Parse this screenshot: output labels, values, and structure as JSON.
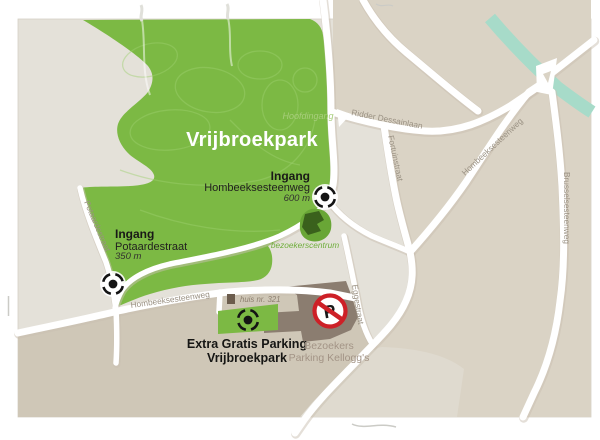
{
  "map": {
    "title": "Vrijbroekpark",
    "labels": {
      "hoofdingang": "Hoofdingang",
      "bezoekerscentrum": "bezoekerscentrum",
      "huis": "huis nr. 321",
      "parking_line1": "Extra Gratis Parking",
      "parking_line2": "Vrijbroekpark",
      "kelloggs_line1": "Bezoekers",
      "kelloggs_line2": "Parking Kellogg's",
      "no_parking_letter": "P"
    },
    "entrances": {
      "east": {
        "title": "Ingang",
        "street": "Hombeeksesteenweg",
        "distance": "600 m"
      },
      "west": {
        "title": "Ingang",
        "street": "Potaardestraat",
        "distance": "350 m"
      }
    },
    "streets": {
      "ridder": "Ridder Dessainlaan",
      "fortuin": "Fortuinstraat",
      "hombeek_diag": "Hombeeksesteenweg",
      "brussels": "Brusselsesteenweg",
      "egge": "Eggestraat",
      "hombeek_bottom": "Hombeeksesteenweg",
      "potaarde_road": "Potaardestraat"
    },
    "colors": {
      "park_green": "#7cb944",
      "park_path": "#9ed06e",
      "building_dark_green": "#3a611c",
      "island_green": "#69a636",
      "canal": "#a7dbc9",
      "base_gray": "#e4e1d9",
      "beige": "#dad3c5",
      "tan_dark": "#cfc7b7",
      "light_patch": "#dfdacf",
      "road_white": "#ffffff",
      "road_halo": "#c9c0b1",
      "street_label": "#9a9183",
      "kelloggs_area": "#8b7d70",
      "kelloggs_text": "#a39486",
      "sign_red": "#cd2027",
      "huis_square": "#6b5c4d",
      "huis_text": "#8d7f6f",
      "hoofdingang_text": "#a8ce7c",
      "bezoekerscentrum_text": "#6fae3c",
      "title_white": "#ffffff",
      "marker_black": "#141414"
    }
  }
}
